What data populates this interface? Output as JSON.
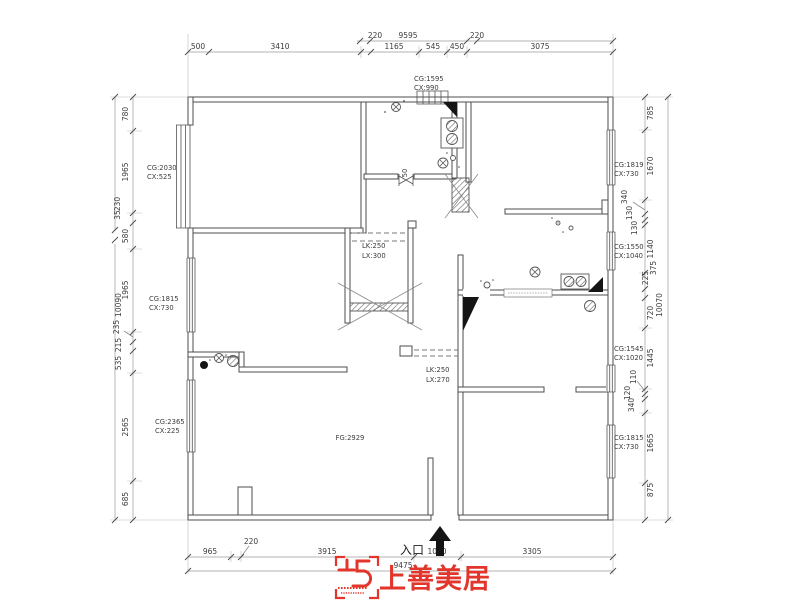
{
  "drawing": {
    "top": {
      "row1": [
        "220",
        "9595",
        "220"
      ],
      "row2": [
        "500",
        "3410",
        "1165",
        "545",
        "450",
        "3075"
      ]
    },
    "left": {
      "segments": [
        "780",
        "1965",
        "580",
        "1965",
        "235",
        "215",
        "535",
        "2565",
        "685"
      ],
      "break_labels": [
        "230",
        "35"
      ],
      "total": "10090"
    },
    "right": {
      "segments": [
        "785",
        "1670",
        "340",
        "130",
        "130",
        "1140",
        "375",
        "225",
        "720",
        "1445",
        "110",
        "120",
        "340",
        "1665",
        "875"
      ],
      "total": "10070"
    },
    "bottom": {
      "row1": [
        "965",
        "220",
        "3915",
        "1070",
        "3305"
      ],
      "total": "9475"
    },
    "windows": [
      {
        "cg": "CG:1595",
        "cx": "CX:990"
      },
      {
        "cg": "CG:2030",
        "cx": "CX:525"
      },
      {
        "cg": "CG:1819",
        "cx": "CX:730"
      },
      {
        "cg": "CG:1550",
        "cx": "CX:1040"
      },
      {
        "cg": "CG:1815",
        "cx": "CX:730"
      },
      {
        "cg": "CG:1545",
        "cx": "CX:1020"
      },
      {
        "cg": "CG:2365",
        "cx": "CX:225"
      },
      {
        "cg": "CG:1815",
        "cx": "CX:730"
      }
    ],
    "beams": [
      {
        "lk": "LK:250",
        "lx": "LX:300"
      },
      {
        "lk": "LK:250",
        "lx": "LX:270"
      }
    ],
    "floor_label": "FG:2929",
    "door_width": "50",
    "entrance_label": "入口"
  },
  "logo": {
    "brand": "上善美居",
    "color": "#e2352b"
  }
}
